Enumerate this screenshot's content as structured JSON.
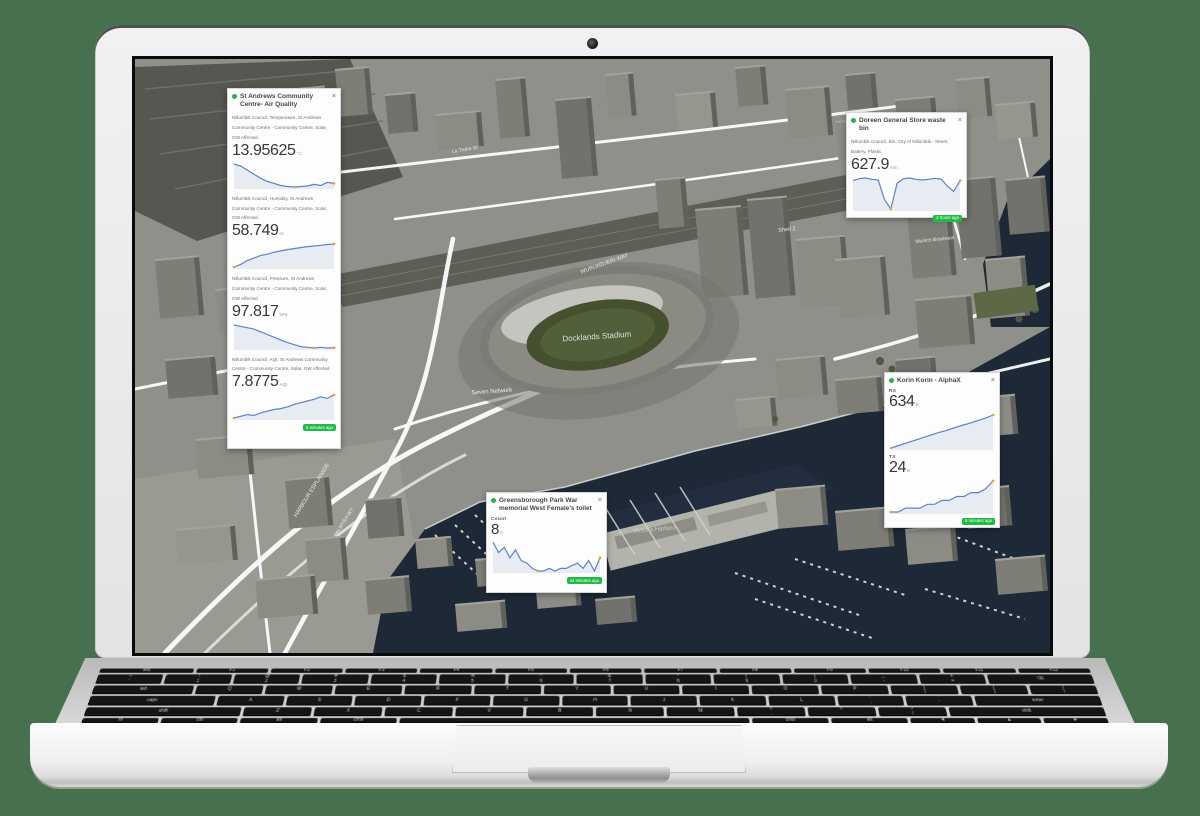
{
  "ui": {
    "close_glyph": "×"
  },
  "map": {
    "labels": [
      {
        "text": "Docklands Stadium",
        "x": 462,
        "y": 280,
        "r": -4,
        "s": 8,
        "o": 0.8
      },
      {
        "text": "Seven Network",
        "x": 357,
        "y": 334,
        "r": -4,
        "s": 6,
        "o": 0.85
      },
      {
        "text": "WURUNDJERI WAY",
        "x": 470,
        "y": 206,
        "r": -20,
        "s": 5.5,
        "o": 0.8
      },
      {
        "text": "HARBOUR ESPLANADE",
        "x": 178,
        "y": 432,
        "r": -58,
        "s": 5.5,
        "o": 0.85
      },
      {
        "text": "PALMYRA WY",
        "x": 210,
        "y": 464,
        "r": -58,
        "s": 5,
        "o": 0.8
      },
      {
        "text": "La Trobe St",
        "x": 330,
        "y": 92,
        "r": -10,
        "s": 5,
        "o": 0.8
      },
      {
        "text": "Shed 2",
        "x": 652,
        "y": 172,
        "r": -6,
        "s": 5.5,
        "o": 0.85
      },
      {
        "text": "Munich Brauhaus",
        "x": 800,
        "y": 182,
        "r": -6,
        "s": 5,
        "o": 0.85
      },
      {
        "text": "NewQuay Promenade",
        "x": 762,
        "y": 120,
        "r": -8,
        "s": 5,
        "o": 0.75
      },
      {
        "text": "Victoria Harbour",
        "x": 520,
        "y": 472,
        "r": -5,
        "s": 6,
        "o": 0.55
      }
    ]
  },
  "panels": {
    "air_quality": {
      "title": "St Andrews Community Centre- Air Quality",
      "badge": "5 minutes ago",
      "metrics": [
        {
          "desc": "Nillumbik Council, Temperature, St Andrews Community Centre - Community Centre, Solar, GW Affected",
          "value": "13.95625",
          "unit": "°C"
        },
        {
          "desc": "Nillumbik Council, Humidity, St Andrews Community Centre - Community Centre, Solar, GW Affected",
          "value": "58.749",
          "unit": "%"
        },
        {
          "desc": "Nillumbik Council, Pressure, St Andrews Community Centre - Community Centre, Solar, GW Affected",
          "value": "97.817",
          "unit": "kPa"
        },
        {
          "desc": "Nillumbik Council, AQI, St Andrews Community Centre - Community Centre, Solar, GW Affected",
          "value": "7.8775",
          "unit": "AQI"
        }
      ]
    },
    "waste_bin": {
      "title": "Doreen General Store waste bin",
      "badge": "2 hours ago",
      "metrics": [
        {
          "desc": "Nillumbik Council, Bin, City of Nillumbik - Street, Battery, Plastic",
          "value": "627.9",
          "unit": "mm"
        }
      ]
    },
    "korin": {
      "title": "Korin Korin - AlphaX",
      "badge": "6 minutes ago",
      "metrics": [
        {
          "desc": "RX",
          "value": "634",
          "unit": "B"
        },
        {
          "desc": "TX",
          "value": "24",
          "unit": "B"
        }
      ]
    },
    "toilet": {
      "title": "Greensborough Park War memorial West Female's toilet",
      "badge": "44 minutes ago",
      "metrics": [
        {
          "desc": "Count",
          "value": "8",
          "unit": "#"
        }
      ]
    }
  },
  "chart_data": {
    "type": "line",
    "series": [
      {
        "id": "temperature",
        "label": "Temperature °C",
        "values": [
          15.2,
          15.0,
          14.6,
          14.2,
          13.8,
          13.5,
          13.3,
          13.1,
          13.0,
          12.95,
          13.0,
          13.05,
          13.2,
          13.1,
          13.4,
          13.3
        ]
      },
      {
        "id": "humidity",
        "label": "Humidity %",
        "values": [
          52,
          53,
          54.5,
          55.5,
          56.5,
          57,
          57.8,
          58.3,
          58.8,
          59.2,
          59.6,
          60,
          60.2,
          60.5,
          60.8,
          61
        ]
      },
      {
        "id": "pressure",
        "label": "Pressure kPa",
        "values": [
          98.6,
          98.5,
          98.4,
          98.3,
          98.1,
          97.9,
          97.7,
          97.5,
          97.3,
          97.15,
          97.0,
          96.95,
          96.9,
          96.95,
          96.9,
          96.92
        ]
      },
      {
        "id": "aqi",
        "label": "AQI",
        "values": [
          5.9,
          6.1,
          6.3,
          6.2,
          6.5,
          6.7,
          6.9,
          7.0,
          7.2,
          7.5,
          7.7,
          7.9,
          8.1,
          8.4,
          8.2,
          8.6
        ]
      },
      {
        "id": "bin_fill",
        "label": "Bin fill mm",
        "values": [
          640,
          655,
          660,
          650,
          645,
          500,
          430,
          620,
          655,
          660,
          650,
          645,
          650,
          658,
          652,
          600,
          560,
          640
        ]
      },
      {
        "id": "rx",
        "label": "RX",
        "values": [
          180,
          215,
          250,
          285,
          320,
          355,
          390,
          420,
          455,
          490,
          520,
          555,
          590,
          634
        ]
      },
      {
        "id": "tx",
        "label": "TX",
        "values": [
          8,
          8,
          10,
          10,
          10,
          12,
          12,
          14,
          14,
          16,
          16,
          18,
          18,
          20,
          24
        ]
      },
      {
        "id": "count",
        "label": "Count",
        "values": [
          14,
          10,
          12,
          8,
          11,
          7,
          6,
          4,
          3,
          3,
          4,
          3,
          4,
          4,
          5,
          6,
          4,
          7,
          3,
          8
        ]
      }
    ]
  },
  "laptop": {
    "keyboard_rows": [
      [
        "esc",
        "F1",
        "F2",
        "F3",
        "F4",
        "F5",
        "F6",
        "F7",
        "F8",
        "F9",
        "F10",
        "F11",
        "F12"
      ],
      [
        "~\n`",
        "!\n1",
        "@\n2",
        "#\n3",
        "$\n4",
        "%\n5",
        "^\n6",
        "&\n7",
        "*\n8",
        "(\n9",
        ")\n0",
        "_\n-",
        "+\n=",
        "⌫"
      ],
      [
        "tab",
        "Q",
        "W",
        "E",
        "R",
        "T",
        "Y",
        "U",
        "I",
        "O",
        "P",
        "{\n[",
        "}\n]",
        "|\n\\"
      ],
      [
        "caps",
        "A",
        "S",
        "D",
        "F",
        "G",
        "H",
        "J",
        "K",
        "L",
        ":\n;",
        "\"\n'",
        "enter"
      ],
      [
        "shift",
        "Z",
        "X",
        "C",
        "V",
        "B",
        "N",
        "M",
        "<\n,",
        ">\n.",
        "?\n/",
        "shift"
      ],
      [
        "fn",
        "ctrl",
        "alt",
        "cmd",
        "",
        "cmd",
        "alt",
        "◄",
        "▲",
        "►"
      ]
    ]
  }
}
